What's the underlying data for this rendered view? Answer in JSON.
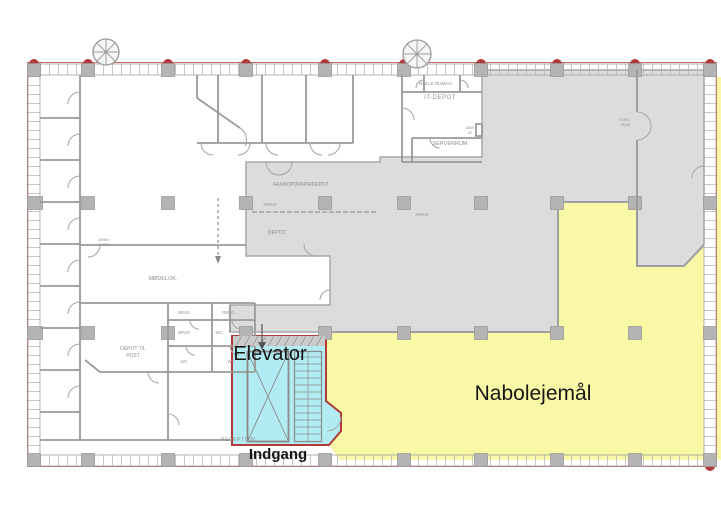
{
  "plan": {
    "type": "floor-plan",
    "language": "da",
    "main_labels": {
      "elevator": "Elevator",
      "indgang": "Indgang",
      "nabolejemaal": "Nabolejemål",
      "reception": "RECEPTION"
    },
    "room_labels": {
      "rulle_rum": "RULLE RUM/VC",
      "it_depot": "IT-DEPOT",
      "serverrum": "SERVERRUM",
      "volt_1": "380V",
      "volt_2": "42",
      "tekn_1": "TEKN.",
      "tekn_2": "RUM",
      "fax_kopi": "FAX/KOPI/PAPIRDEPOT",
      "arkiv_1": "ARKIV",
      "depot": "DEPOT",
      "arkiv_2": "ARKIV",
      "moedelok": "MØDELOK.",
      "arkiv_bord_1": "ARKIV",
      "arkiv_bord_2": "BORD",
      "depot_post_1": "DEPOT TIL",
      "depot_post_2": "POST",
      "brus_1": "BRUS",
      "reng": "RENG.",
      "brus_2": "BRUS",
      "wc_1": "WC",
      "wc_2": "WC",
      "wc_3": "WC"
    },
    "colors": {
      "tenancy_yellow": "#f8f8a6",
      "entrance_cyan": "#b2ecf2",
      "common_gray": "#dcdcdc",
      "wall_gray": "#9a9a9a",
      "boundary_red": "#b23a38",
      "facade_red": "#cc6a66",
      "column_gray": "#b4b4b4",
      "label_gray": "#8f8f8f"
    }
  }
}
